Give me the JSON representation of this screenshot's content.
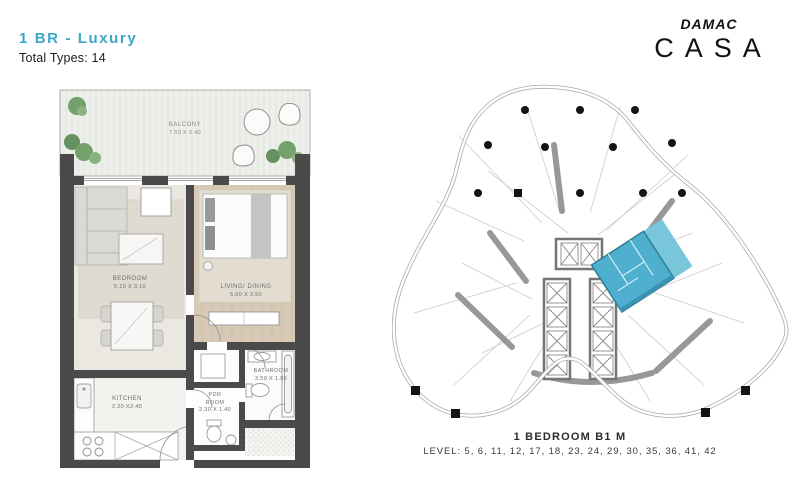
{
  "header": {
    "title": "1 BR - Luxury",
    "subtitle": "Total Types: 14"
  },
  "logo": {
    "brand": "DAMAC",
    "name": "CASA"
  },
  "colors": {
    "accent": "#3ba6c9",
    "highlight_unit": "#4fafce",
    "highlight_balcony": "#79c6db",
    "walls": "#4a4a4a"
  },
  "floorplan": {
    "rooms": {
      "balcony": {
        "name": "BALCONY",
        "dims": "7.50 X 2.40"
      },
      "bedroom": {
        "name": "BEDROOM",
        "dims": "5.10 X 3.10"
      },
      "living": {
        "name": "LIVING/ DINING",
        "dims": "5.60 X 3.50"
      },
      "kitchen": {
        "name": "KITCHEN",
        "dims": "2.20 X2.40"
      },
      "bathroom": {
        "name": "BATHROOM",
        "dims": "3.50 X 1.90"
      },
      "pdr": {
        "name": "PDR ROOM",
        "dims": "2.30 X 1.40"
      }
    }
  },
  "keyplan": {
    "unit_label": "1 BEDROOM B1 M",
    "levels": "LEVEL: 5, 6, 11, 12, 17, 18, 23, 24, 29, 30, 35, 36, 41, 42"
  }
}
